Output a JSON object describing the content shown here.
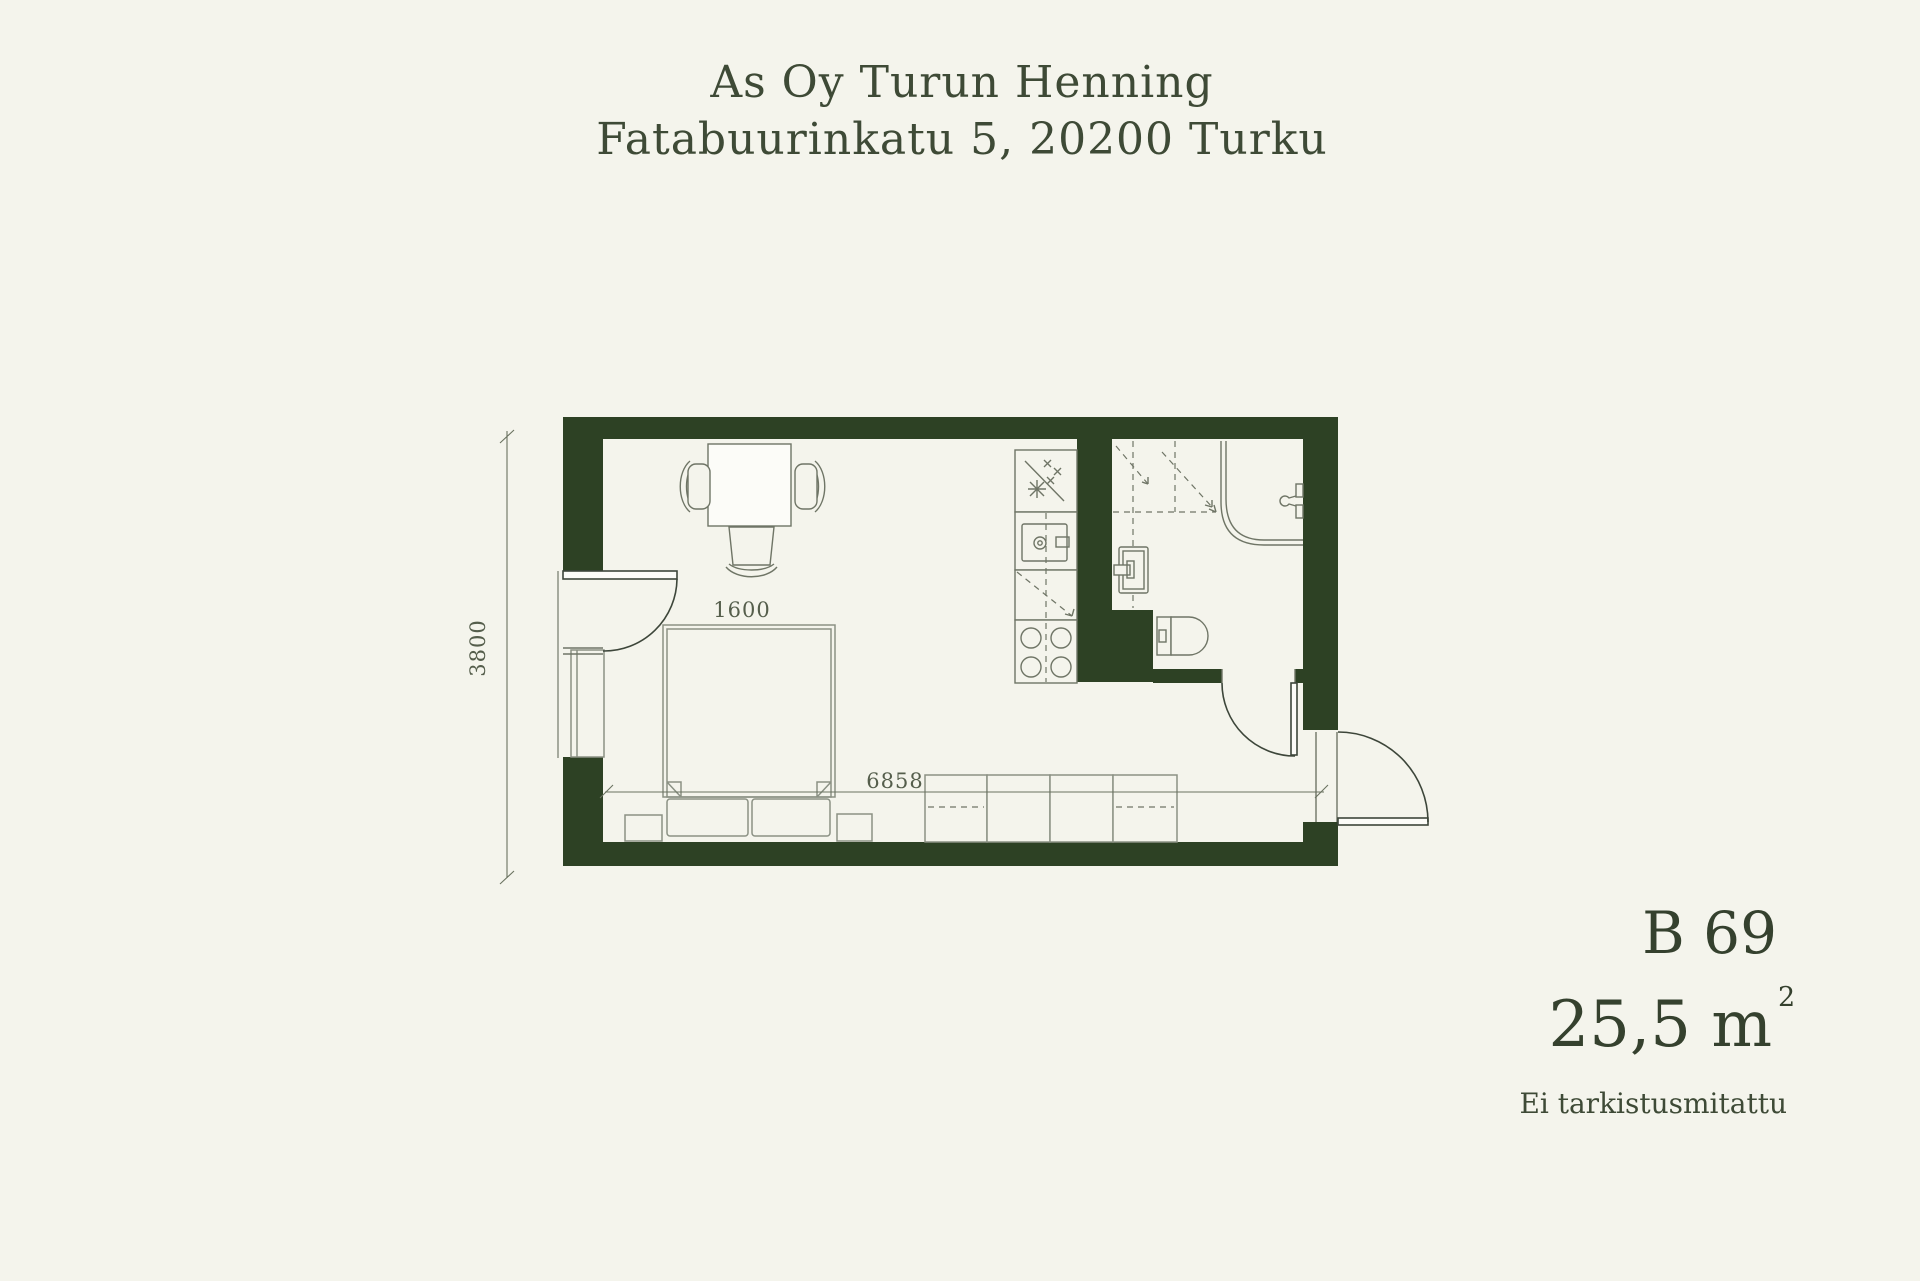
{
  "header": {
    "line1": "As Oy Turun Henning",
    "line2": "Fatabuurinkatu 5, 20200 Turku"
  },
  "unit": {
    "id": "B 69",
    "area": "25,5 m",
    "area_superscript": "2",
    "note": "Ei tarkistusmitattu"
  },
  "plan": {
    "dim_height": "3800",
    "dim_width": "6858",
    "dim_bed": "1600",
    "fixtures": [
      "dining-table",
      "dining-chairs",
      "balcony-door",
      "window",
      "bed",
      "pillows",
      "bedside-tables",
      "wardrobes",
      "kitchen-sink",
      "dishwasher",
      "appliance-reservation",
      "stove",
      "washer-reservation",
      "shower-screen",
      "shower-tap",
      "bathroom-sink",
      "toilet",
      "bathroom-door",
      "entrance-door"
    ]
  },
  "colors": {
    "background": "#f4f4ec",
    "wall": "#2d4124",
    "line_dark": "#3d463a",
    "line_mid": "#6f7566",
    "line_light": "#8b9184",
    "text": "#3e4a36"
  }
}
